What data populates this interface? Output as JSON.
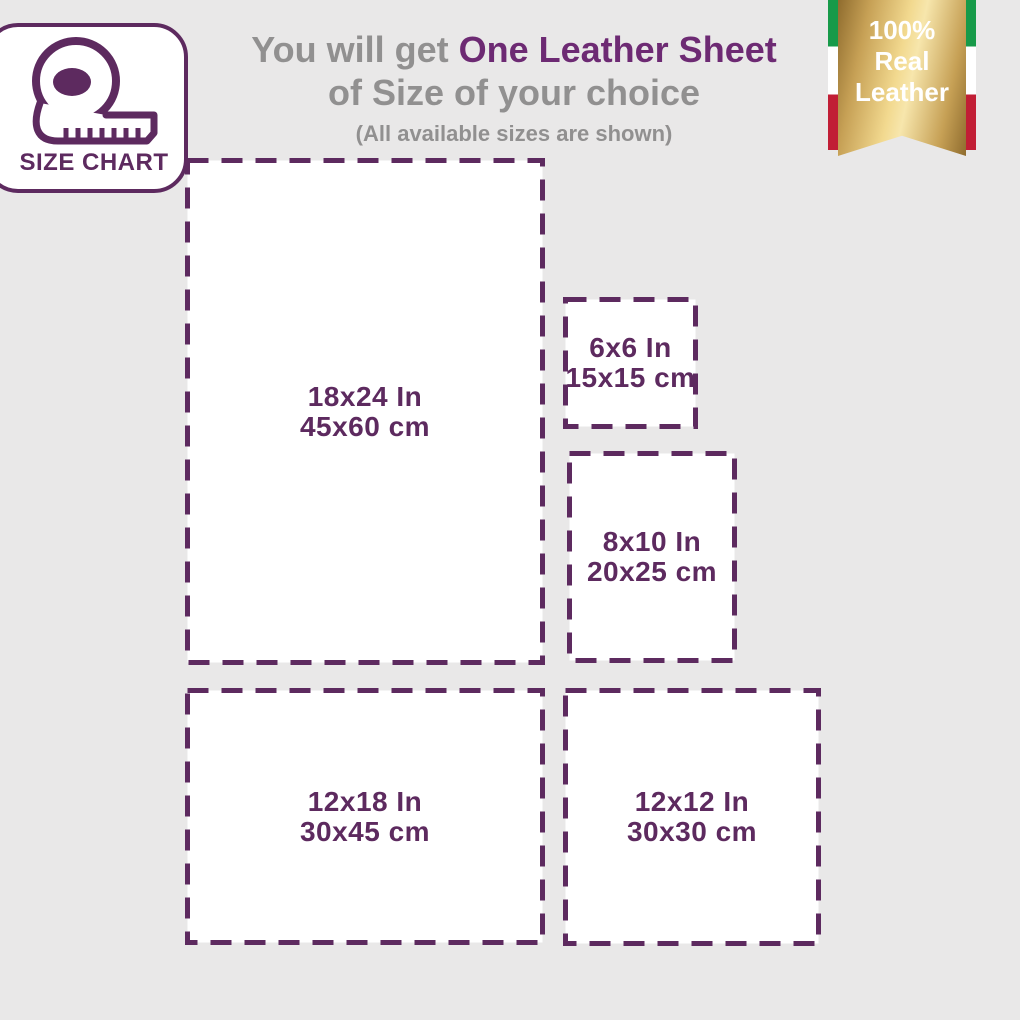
{
  "colors": {
    "background": "#e9e8e8",
    "purple": "#5d2a5f",
    "title_purple": "#6d2a73",
    "gray": "#919090",
    "flag_green": "#179a49",
    "flag_red": "#c11e35",
    "gold_dark": "#8f6c2e",
    "gold_mid": "#c6a055",
    "gold_light": "#f2d98f",
    "gold_highlight": "#f7e6ac",
    "white": "#ffffff"
  },
  "card": {
    "label": "SIZE CHART",
    "icon": "measuring-tape-icon"
  },
  "title": {
    "prefix": "You will get ",
    "highlight": "One Leather Sheet",
    "line2": "of Size of your choice",
    "note": "(All available sizes are shown)"
  },
  "badge": {
    "lines": [
      "100%",
      "Real",
      "Leather"
    ]
  },
  "sizes": [
    {
      "id": "18x24",
      "inches": "18x24 In",
      "cm": "45x60 cm"
    },
    {
      "id": "6x6",
      "inches": "6x6 In",
      "cm": "15x15 cm"
    },
    {
      "id": "8x10",
      "inches": "8x10 In",
      "cm": "20x25 cm"
    },
    {
      "id": "12x18",
      "inches": "12x18 In",
      "cm": "30x45 cm"
    },
    {
      "id": "12x12",
      "inches": "12x12 In",
      "cm": "30x30 cm"
    }
  ]
}
